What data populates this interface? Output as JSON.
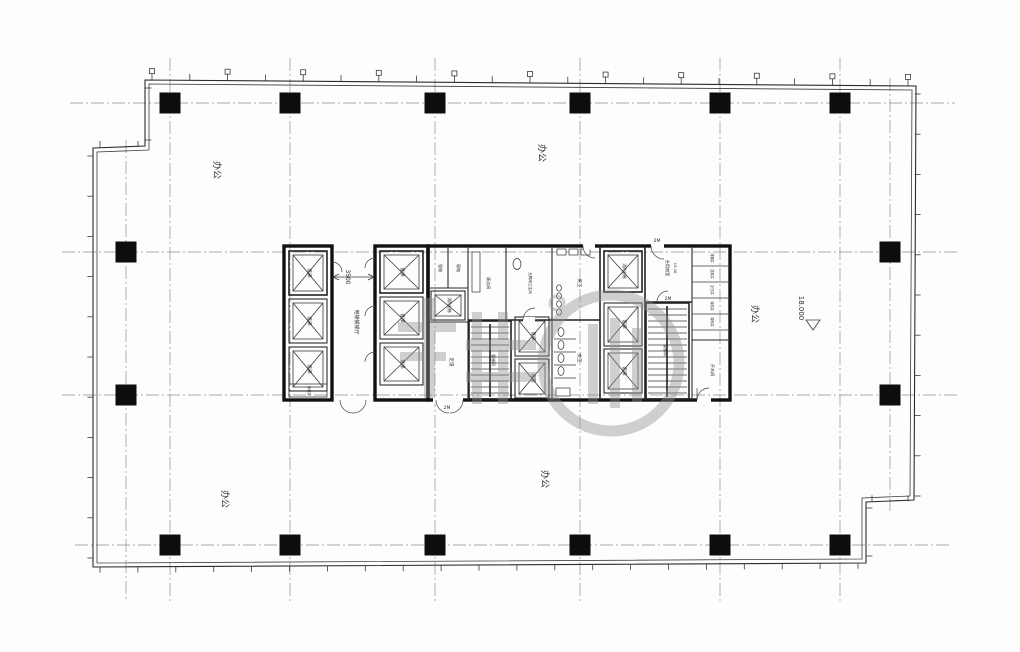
{
  "drawing": {
    "area_labels": {
      "office_top_left": "办公",
      "office_top_center": "办公",
      "office_right": "办公",
      "office_bottom_left": "办公",
      "office_bottom_center": "办公"
    },
    "elevation_value": "18.000",
    "dim_lobby": "3500",
    "core": {
      "lobby": "电梯候梯厅",
      "passenger_lift": "客梯",
      "fire_lift": "消防电梯",
      "strong_electric": "强电",
      "weak_electric": "弱电",
      "corridor": "走道",
      "mens_wc": "男卫",
      "womens_wc": "女卫",
      "accessible_wc": "无障碍卫生间",
      "cleaning_room": "清洁间",
      "shared_front_room": "合用前室",
      "shared_front_room_area": "15.46",
      "stair": "楼梯间",
      "water_room": "开水间",
      "tank_room": "水暖井",
      "door_mark": "2M",
      "shafts": [
        "排烟井",
        "送风井",
        "正压井",
        "强电井",
        "弱电井"
      ]
    }
  }
}
